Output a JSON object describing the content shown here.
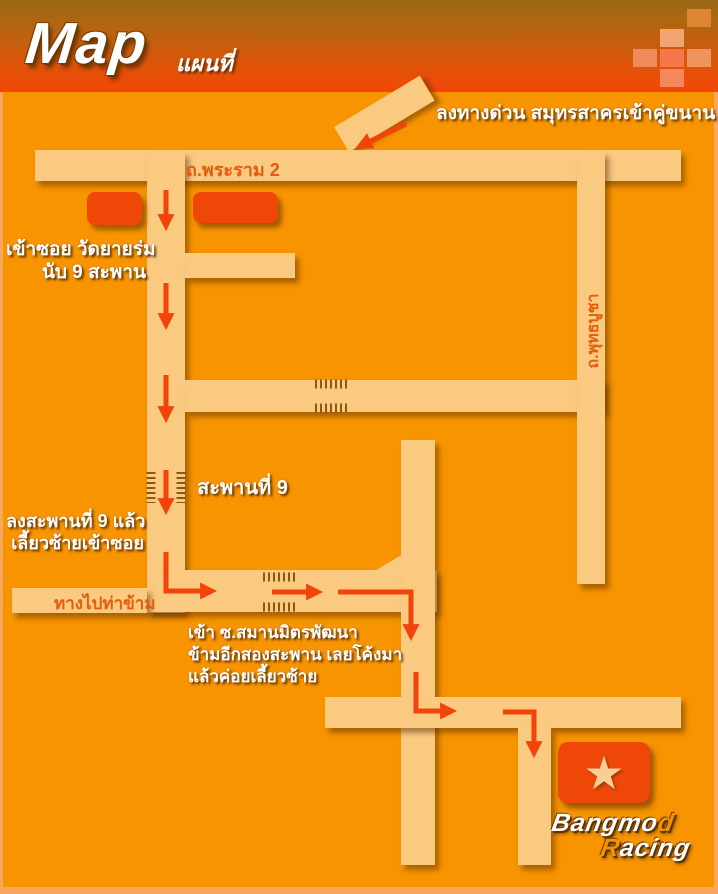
{
  "title": {
    "main": "Map",
    "sub": "แผนที่"
  },
  "header": {
    "squares": [
      {
        "x": 687,
        "y": 9,
        "color": "#DE8534"
      },
      {
        "x": 660,
        "y": 29,
        "color": "#F2A472"
      },
      {
        "x": 633,
        "y": 49,
        "color": "#EF8A5A"
      },
      {
        "x": 660,
        "y": 49,
        "color": "#F4764A"
      },
      {
        "x": 687,
        "y": 49,
        "color": "#F0945E"
      },
      {
        "x": 660,
        "y": 69,
        "color": "#F2885C"
      }
    ]
  },
  "roads": {
    "rama2": "ถ.พระราม 2",
    "phutthabucha": "ถ.พุทธบูชา",
    "thakham": "ทางไปท่าข้าม"
  },
  "annotations": {
    "expressway": "ลงทางด่วน สมุทรสาครเข้าคู่ขนาน",
    "soi_entry_line1": "เข้าซอย วัดยายร่ม",
    "soi_entry_line2": "นับ 9 สะพาน",
    "bridge9": "สะพานที่ 9",
    "after_bridge_line1": "ลงสะพานที่ 9 แล้ว",
    "after_bridge_line2": "เลี้ยวซ้ายเข้าซอย",
    "samanmit_line1": "เข้า ซ.สมานมิตรพัฒนา",
    "samanmit_line2": "ข้ามอีกสองสะพาน เลยโค้งมา",
    "samanmit_line3": "แล้วค่อยเลี้ยวซ้าย"
  },
  "branding": {
    "star_icon": "star",
    "line1_white": "Bangmo",
    "line1_orange": "d",
    "line2_orange": "R",
    "line2_white": "acing"
  },
  "colors": {
    "background": "#F79400",
    "road": "#FACA81",
    "accent_red": "#EE4708",
    "arrow_red": "#F2430A",
    "label_orange": "#E65B0C",
    "header_top": "#9A6A15",
    "header_bottom": "#F34608",
    "frame_border": "#F8A75F",
    "star": "#F8CE96",
    "bridge_tick": "#7A4500"
  }
}
